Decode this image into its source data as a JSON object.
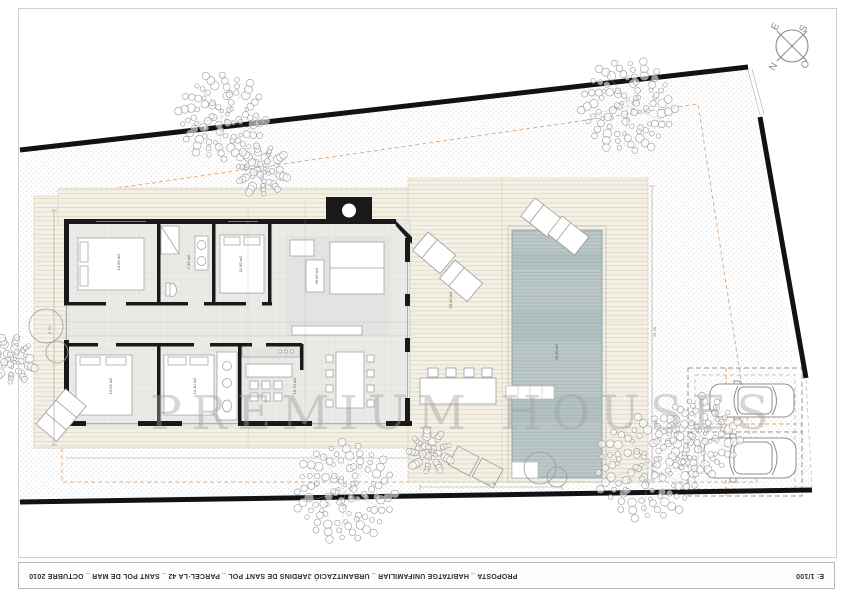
{
  "sheet": {
    "title": "PROPOSTA _ HABITATGE UNIFAMILIAR _ URBANITZACIÓ JARDINS DE SANT POL _ PARCEL·LA 42 _ SANT POL DE MAR _ OCTUBRE 2010",
    "scale": "E: 1/100",
    "watermark": "PREMIUM HOUSES"
  },
  "compass": {
    "north": "N",
    "south": "S",
    "east": "E",
    "west": "O"
  },
  "plan": {
    "room_labels": [
      "13.60 m2",
      "7.15 m2",
      "11.90 m2",
      "49.80 m2",
      "13.05 m2",
      "12.40 m2",
      "16.70 m2",
      "50.00 m2",
      "35.00 m2"
    ],
    "dim_labels": [
      "25.30",
      "10.35",
      "9.70"
    ]
  },
  "colors": {
    "wall": "#1a1a1a",
    "setback_dash": "#e2a06a",
    "pool_water": "#bcc8c8",
    "deck_wood": "#f4f0e5",
    "gravel_dot": "#c9c9c9"
  }
}
